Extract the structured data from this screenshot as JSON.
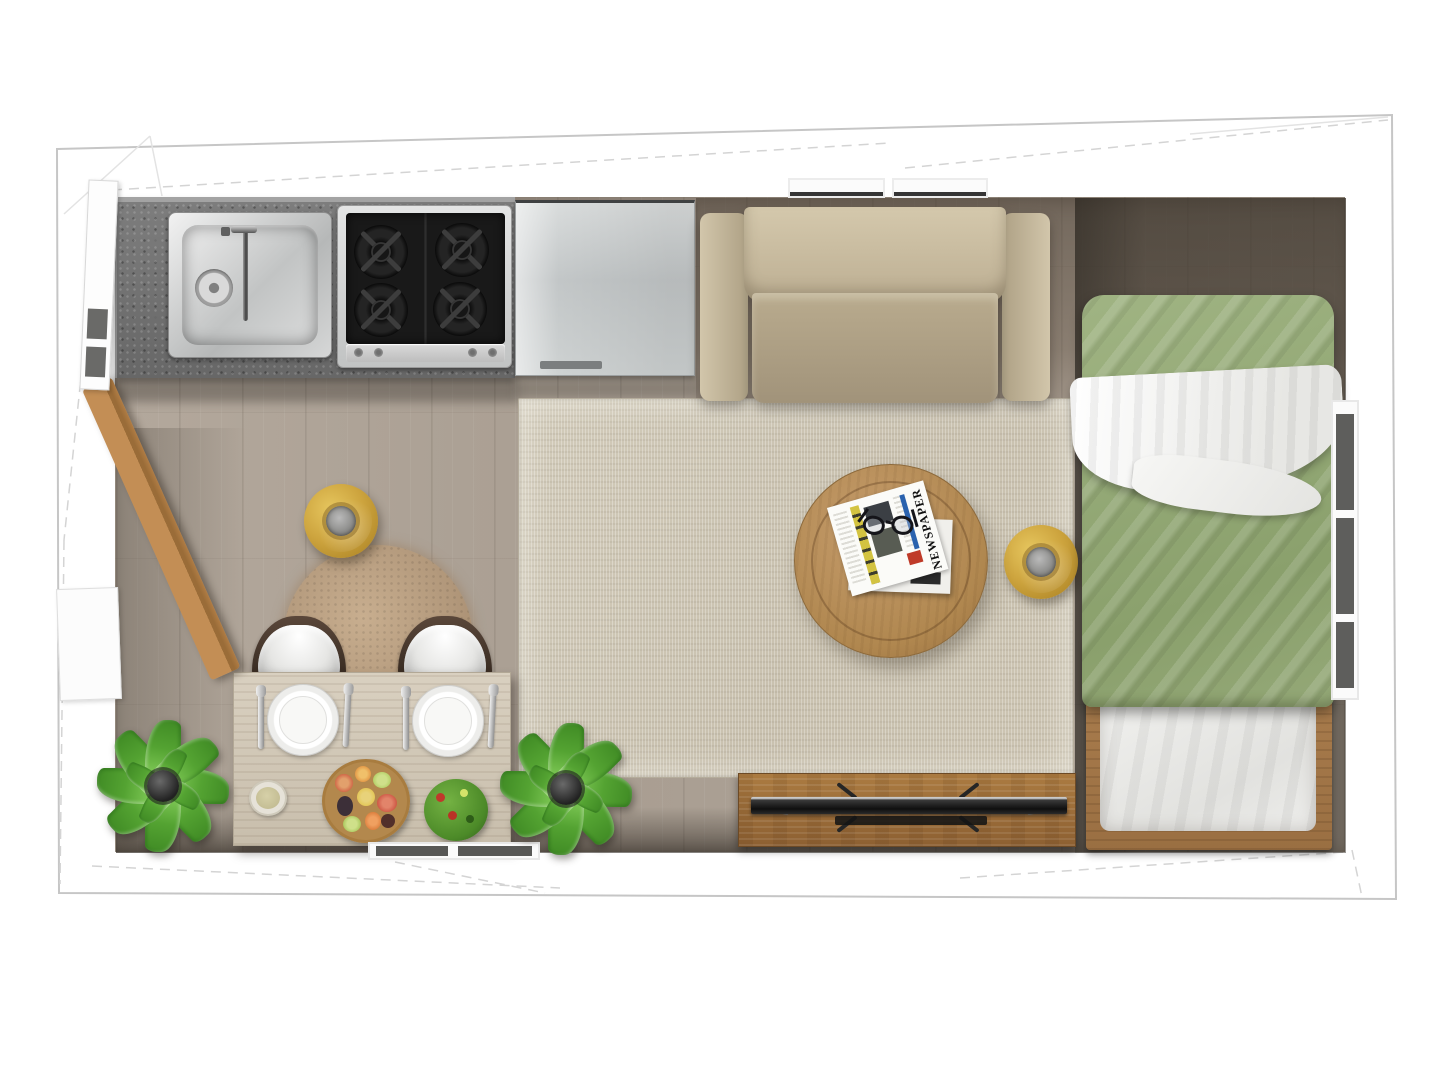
{
  "scene": {
    "type": "floor-plan-top-view",
    "areas": [
      "kitchen",
      "living",
      "dining",
      "sleeping"
    ]
  },
  "labels": {
    "newspaper_masthead": "NEWSPAPER"
  },
  "colors": {
    "wall": "#ffffff",
    "outline": "#c6c6c6",
    "floor_light": "#afa498",
    "floor_dark": "#807468",
    "floor_shadow": "#57504a",
    "countertop_granite": "#707070",
    "stainless_steel": "#d3d5d5",
    "cooktop_black": "#1b1b1b",
    "sofa_beige": "#c3b69b",
    "area_rug": "#ccc4b3",
    "round_fluffy_rug": "#b2977a",
    "coffee_table_wood": "#b58a58",
    "stool_gold": "#cba43e",
    "bed_duvet_green": "#93a877",
    "bed_blanket_white": "#f2f2f0",
    "bed_frame_wood": "#a5794a",
    "dining_table_wood": "#d1c7b6",
    "chair_seat_white": "#f1f0ee",
    "chair_frame_brown": "#403228",
    "tv_console_walnut": "#9c6d3f",
    "tv_black": "#181818",
    "plant_green": "#57a838",
    "plank_wood": "#b5854f"
  },
  "furniture": {
    "kitchen": [
      "granite-countertop",
      "stainless-sink",
      "faucet",
      "gas-cooktop-4-burners",
      "refrigerator"
    ],
    "living": [
      "sofa",
      "area-rug",
      "round-coffee-table",
      "newspaper",
      "eyeglasses",
      "gold-side-stool",
      "tv-console",
      "flat-tv"
    ],
    "dining": [
      "dining-table",
      "chair",
      "chair",
      "plate-setting",
      "plate-setting",
      "small-bowl",
      "vegetable-bowl",
      "salad-bowl",
      "round-fluffy-rug",
      "gold-side-stool"
    ],
    "sleeping": [
      "single-bed",
      "green-duvet",
      "white-blanket",
      "foot-pillow",
      "wood-bed-frame"
    ],
    "decor": [
      "potted-plant",
      "potted-plant",
      "leaning-wood-plank"
    ],
    "openings": [
      "left-door",
      "left-lower-door",
      "top-window",
      "top-window",
      "right-window",
      "bottom-window"
    ]
  }
}
